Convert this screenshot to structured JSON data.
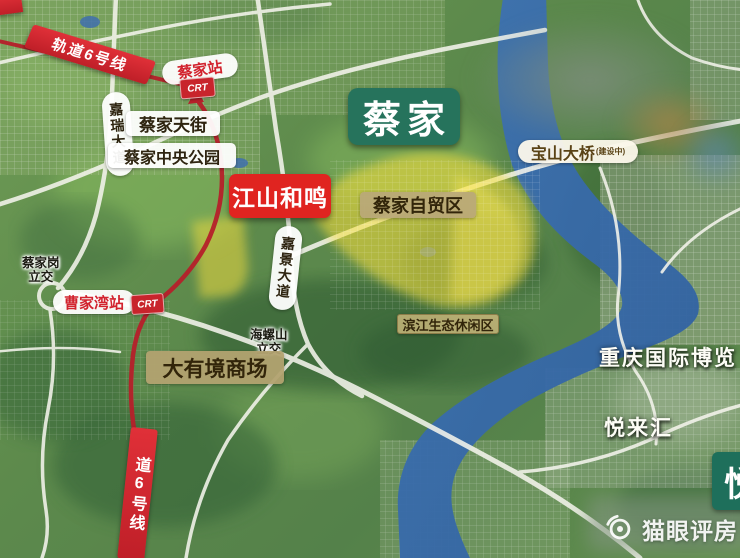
{
  "map": {
    "region_name": "蔡家",
    "project_name": "江山和鸣",
    "rail": {
      "line_banner_top": "轨道6号线",
      "line_banner_bottom": "道6号线",
      "station_caijia": "蔡家站",
      "station_caojiawan": "曹家湾站",
      "crt_logo_text": "CRT"
    },
    "roads": {
      "jiarui_avenue": "嘉瑞大道",
      "jiajing_avenue": "嘉景大道",
      "baoshan_bridge": "宝山大桥",
      "baoshan_bridge_note": "(建设中)"
    },
    "interchanges": {
      "caijiagang": {
        "line1": "蔡家岗",
        "line2": "立交"
      },
      "hailuoshan": {
        "line1": "海螺山",
        "line2": "立交"
      }
    },
    "places": {
      "caijia_tianjie": "蔡家天街",
      "caijia_central_park": "蔡家中央公园",
      "free_trade_zone": "蔡家自贸区",
      "riverside_eco_zone": "滨江生态休闲区",
      "dayoujing_mall": "大有境商场",
      "expo_center": "重庆国际博览",
      "yuelai_hui": "悦来汇",
      "partial_label_right": "悦"
    },
    "watermark": {
      "text": "猫眼评房"
    },
    "colors": {
      "metro_line_red": "#b5202a",
      "banner_red": "#cf2330",
      "region_box_green": "#26735c",
      "project_box_red": "#e02420",
      "zone_highlight_yellow": "#fae03c",
      "label_tan": "#b9a878",
      "river_blue": "#3a6cae"
    }
  }
}
